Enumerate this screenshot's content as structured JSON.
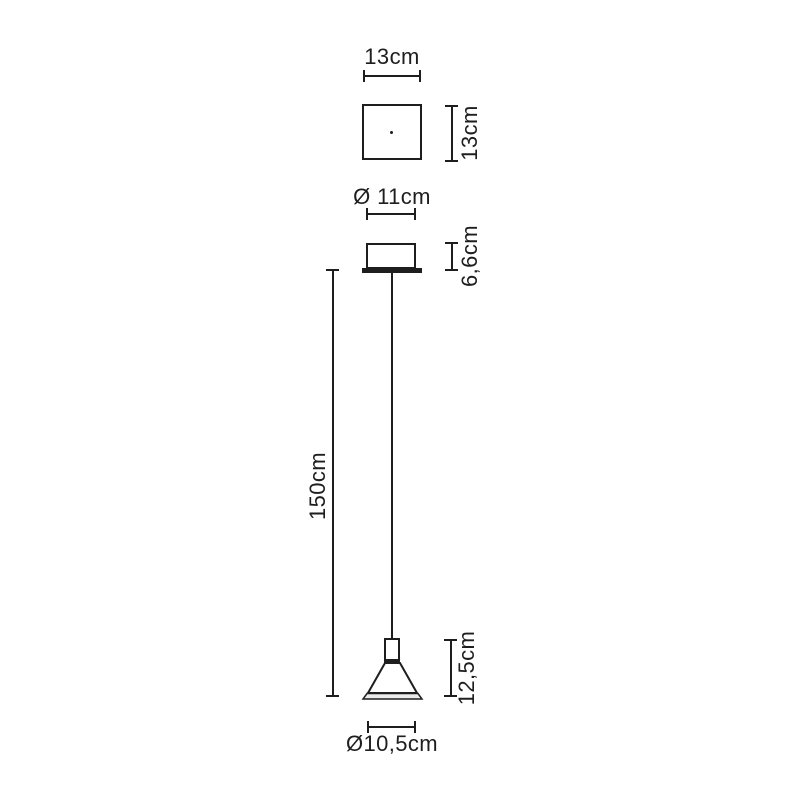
{
  "diagram": {
    "labels": {
      "plate_width": "13cm",
      "plate_height": "13cm",
      "canopy_diameter": "Ø 11cm",
      "canopy_height": "6,6cm",
      "cable_length": "150cm",
      "shade_height": "12,5cm",
      "shade_diameter": "Ø10,5cm"
    },
    "colors": {
      "line": "#1e1e1e",
      "background": "#ffffff",
      "shade_rim_fill": "#ebebeb"
    }
  }
}
